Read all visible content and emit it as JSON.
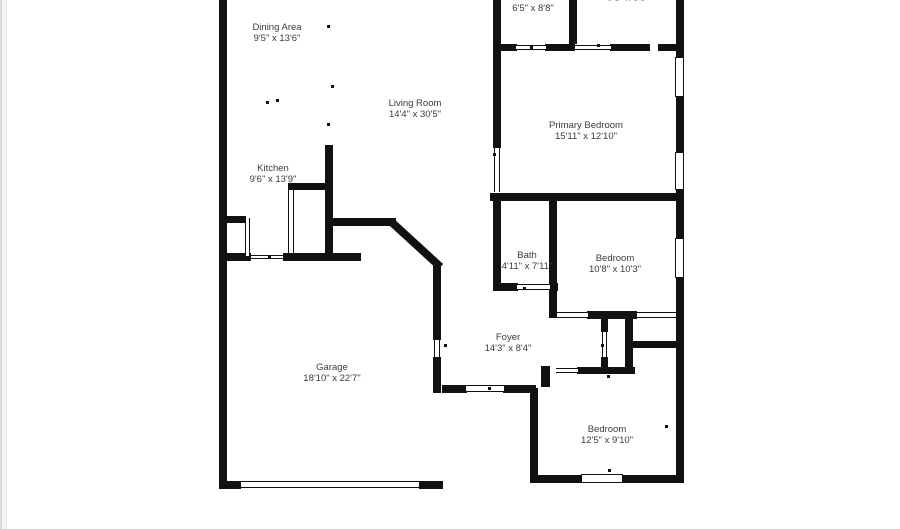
{
  "page": {
    "type": "floor-plan",
    "background": "#ffffff",
    "wall_color": "#111111",
    "text_color": "#3b3b3b",
    "edge_strip_color": "#dcdcdc"
  },
  "rooms": [
    {
      "id": "dining",
      "name": "Dining Area",
      "dims": "9'5\" x 13'6\""
    },
    {
      "id": "living",
      "name": "Living Room",
      "dims": "14'4\" x 30'5\""
    },
    {
      "id": "wic",
      "name": "W.I.C.",
      "dims": "6'5\" x 8'8\""
    },
    {
      "id": "top-right",
      "name": "",
      "dims": "9'3\" x 8'8\""
    },
    {
      "id": "primary",
      "name": "Primary Bedroom",
      "dims": "15'11\" x 12'10\""
    },
    {
      "id": "kitchen",
      "name": "Kitchen",
      "dims": "9'6\" x 13'9\""
    },
    {
      "id": "bath",
      "name": "Bath",
      "dims": "4'11\" x 7'11\""
    },
    {
      "id": "bedroom2",
      "name": "Bedroom",
      "dims": "10'8\" x 10'3\""
    },
    {
      "id": "foyer",
      "name": "Foyer",
      "dims": "14'3\" x 8'4\""
    },
    {
      "id": "garage",
      "name": "Garage",
      "dims": "18'10\" x 22'7\""
    },
    {
      "id": "bedroom3",
      "name": "Bedroom",
      "dims": "12'5\" x 9'10\""
    }
  ]
}
